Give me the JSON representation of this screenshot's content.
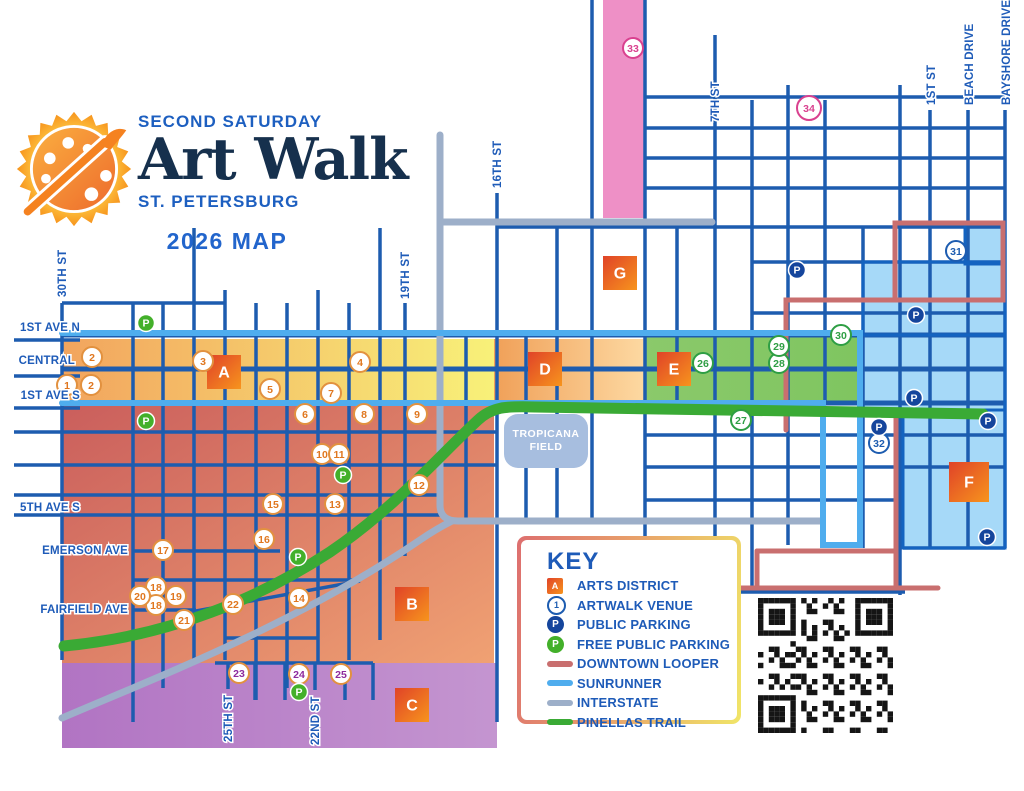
{
  "logo": {
    "line1": "SECOND SATURDAY",
    "line2": "Art Walk",
    "line3": "ST. PETERSBURG",
    "line4": "2026 MAP"
  },
  "key": {
    "title": "KEY",
    "items": [
      {
        "icon": "district-square",
        "label": "ARTS DISTRICT"
      },
      {
        "icon": "venue-circle",
        "label": "ARTWALK VENUE"
      },
      {
        "icon": "public-parking",
        "label": "PUBLIC PARKING"
      },
      {
        "icon": "free-parking",
        "label": "FREE PUBLIC PARKING"
      },
      {
        "icon": "line",
        "label": "DOWNTOWN LOOPER",
        "color": "#c96f6f"
      },
      {
        "icon": "line",
        "label": "SUNRUNNER",
        "color": "#4fadee"
      },
      {
        "icon": "line",
        "label": "INTERSTATE",
        "color": "#9dafc9"
      },
      {
        "icon": "line",
        "label": "PINELLAS TRAIL",
        "color": "#3aaa35"
      }
    ]
  },
  "tropicana": {
    "lines": [
      "TROPICANA",
      "FIELD"
    ],
    "x": 504,
    "y": 414,
    "w": 84,
    "h": 54,
    "fill": "#a7bedf"
  },
  "colors": {
    "street": "#1d5caf",
    "label": "#1e5bb8",
    "looper": "#c96f6f",
    "sunrunner": "#4fadee",
    "interstate": "#9dafc9",
    "trail": "#3aaa35",
    "public_parking": "#15459c",
    "free_parking": "#43b02a",
    "district_grad": [
      "#e04328",
      "#f7941d"
    ]
  },
  "zones": [
    {
      "id": "central-strip",
      "x": 62,
      "y": 339,
      "w": 432,
      "h": 64,
      "c1": "#f2a45e",
      "c2": "#f8f179",
      "dir": "h"
    },
    {
      "id": "d-zone",
      "x": 494,
      "y": 339,
      "w": 151,
      "h": 64,
      "c1": "#f0a058",
      "c2": "#fdd9a2",
      "dir": "h"
    },
    {
      "id": "e-zone",
      "x": 645,
      "y": 337,
      "w": 215,
      "h": 66,
      "c1": "#8bc96b",
      "c2": "#7fc560",
      "dir": "h"
    },
    {
      "id": "salmon-zone",
      "x": 62,
      "y": 403,
      "w": 432,
      "h": 260,
      "c1": "#ca5e5c",
      "c2": "#f0a173",
      "dir": "d"
    },
    {
      "id": "purple-zone",
      "x": 62,
      "y": 663,
      "w": 435,
      "h": 85,
      "c1": "#b174c3",
      "c2": "#c495d0",
      "dir": "h"
    },
    {
      "id": "pink-strip",
      "x": 603,
      "y": 0,
      "w": 41,
      "h": 218,
      "c1": "#ee90c6",
      "c2": "#ee90c6",
      "dir": "h"
    }
  ],
  "blue_zone": {
    "fill": "#a6d9f8",
    "stroke": "#1463c0",
    "rects": [
      [
        965,
        223,
        40,
        41
      ],
      [
        863,
        262,
        142,
        73
      ],
      [
        860,
        335,
        145,
        75
      ],
      [
        903,
        410,
        102,
        138
      ]
    ]
  },
  "streets": {
    "h": [
      [
        303,
        62,
        225
      ],
      [
        335,
        62,
        1005,
        5
      ],
      [
        369,
        62,
        1005,
        5
      ],
      [
        403,
        62,
        1005,
        5
      ],
      [
        432,
        14,
        497
      ],
      [
        465,
        14,
        497
      ],
      [
        495,
        14,
        440
      ],
      [
        515,
        14,
        440
      ],
      [
        551,
        133,
        280
      ],
      [
        580,
        133,
        360
      ],
      [
        610,
        133,
        196
      ],
      [
        638,
        225,
        318
      ],
      [
        663,
        215,
        373
      ],
      [
        97,
        645,
        1005
      ],
      [
        128,
        645,
        1005
      ],
      [
        158,
        645,
        1005
      ],
      [
        188,
        645,
        1005
      ],
      [
        227,
        497,
        1005
      ],
      [
        262,
        752,
        1005
      ],
      [
        313,
        752,
        1005
      ],
      [
        435,
        645,
        1005
      ],
      [
        467,
        645,
        1005
      ],
      [
        500,
        645,
        900
      ],
      [
        548,
        903,
        1005
      ],
      [
        592,
        715,
        905
      ],
      [
        340,
        14,
        80
      ],
      [
        376,
        14,
        80
      ],
      [
        408,
        14,
        80
      ]
    ],
    "v": [
      [
        62,
        303,
        660
      ],
      [
        133,
        303,
        722
      ],
      [
        163,
        303,
        688
      ],
      [
        194,
        228,
        660
      ],
      [
        225,
        290,
        660
      ],
      [
        256,
        303,
        700
      ],
      [
        287,
        303,
        688
      ],
      [
        318,
        290,
        663
      ],
      [
        349,
        303,
        660
      ],
      [
        380,
        228,
        640
      ],
      [
        405,
        303,
        556
      ],
      [
        466,
        335,
        520
      ],
      [
        497,
        193,
        722
      ],
      [
        526,
        335,
        520
      ],
      [
        557,
        227,
        520
      ],
      [
        592,
        0,
        520
      ],
      [
        645,
        0,
        663
      ],
      [
        677,
        227,
        403
      ],
      [
        715,
        35,
        545
      ],
      [
        752,
        100,
        592
      ],
      [
        788,
        85,
        545
      ],
      [
        825,
        100,
        403
      ],
      [
        863,
        227,
        548
      ],
      [
        900,
        85,
        595
      ],
      [
        930,
        110,
        548
      ],
      [
        968,
        110,
        548
      ],
      [
        1005,
        110,
        548
      ],
      [
        228,
        663,
        689
      ],
      [
        255,
        663,
        700
      ],
      [
        285,
        663,
        700
      ],
      [
        315,
        663,
        690
      ],
      [
        345,
        663,
        700
      ],
      [
        373,
        663,
        700
      ]
    ],
    "diag": [
      [
        196,
        611,
        360,
        581
      ]
    ]
  },
  "routes": [
    {
      "name": "interstate",
      "color": "#9dafc9",
      "width": 7,
      "paths": [
        "M 440,135 L 440,505 Q 440,521 458,521 L 820,521",
        "M 62,718 C 160,676 300,622 420,540 Q 436,529 452,521",
        "M 440,222 L 712,222"
      ]
    },
    {
      "name": "downtown-looper",
      "color": "#c96f6f",
      "width": 5,
      "paths": [
        "M 786,430 L 786,300 L 1003,300 L 1003,223 L 895,223 L 895,300",
        "M 896,415 L 896,588",
        "M 757,551 L 896,551",
        "M 757,551 L 757,588",
        "M 650,588 L 938,588"
      ]
    },
    {
      "name": "sunrunner",
      "color": "#4fadee",
      "width": 6,
      "paths": [
        "M 62,333 L 860,333 L 860,545 L 823,545 L 823,403 L 62,403"
      ]
    },
    {
      "name": "pinellas-trail",
      "color": "#3aaa35",
      "width": 11,
      "paths": [
        "M 64,646 C 170,636 260,598 330,552 C 395,508 440,455 478,420 C 492,407 505,406 535,407 L 983,414"
      ]
    }
  ],
  "districts": [
    {
      "letter": "A",
      "x": 224,
      "y": 372
    },
    {
      "letter": "B",
      "x": 412,
      "y": 604
    },
    {
      "letter": "C",
      "x": 412,
      "y": 705
    },
    {
      "letter": "D",
      "x": 545,
      "y": 369
    },
    {
      "letter": "E",
      "x": 674,
      "y": 369
    },
    {
      "letter": "F",
      "x": 969,
      "y": 482,
      "size": 40
    },
    {
      "letter": "G",
      "x": 620,
      "y": 273
    }
  ],
  "venue_styles": {
    "o": {
      "ring": "#e2913f",
      "num": "#e0771f"
    },
    "p": {
      "ring": "#e2913f",
      "num": "#8e2a9e"
    },
    "g": {
      "ring": "#2e9e44",
      "num": "#2e9e44"
    },
    "b": {
      "ring": "#1d5cb0",
      "num": "#1d5cb0"
    },
    "k": {
      "ring": "#d9418f",
      "num": "#d9418f"
    }
  },
  "venues": [
    {
      "n": "1",
      "x": 67,
      "y": 385,
      "c": "o"
    },
    {
      "n": "2",
      "x": 91,
      "y": 385,
      "c": "o"
    },
    {
      "n": "2",
      "x": 92,
      "y": 357,
      "c": "o"
    },
    {
      "n": "3",
      "x": 203,
      "y": 361,
      "c": "o"
    },
    {
      "n": "4",
      "x": 360,
      "y": 362,
      "c": "o"
    },
    {
      "n": "5",
      "x": 270,
      "y": 389,
      "c": "o"
    },
    {
      "n": "6",
      "x": 305,
      "y": 414,
      "c": "o"
    },
    {
      "n": "7",
      "x": 331,
      "y": 393,
      "c": "o"
    },
    {
      "n": "8",
      "x": 364,
      "y": 414,
      "c": "o"
    },
    {
      "n": "9",
      "x": 417,
      "y": 414,
      "c": "o"
    },
    {
      "n": "10",
      "x": 322,
      "y": 454,
      "c": "o"
    },
    {
      "n": "11",
      "x": 339,
      "y": 454,
      "c": "o"
    },
    {
      "n": "12",
      "x": 419,
      "y": 485,
      "c": "o"
    },
    {
      "n": "13",
      "x": 335,
      "y": 504,
      "c": "o"
    },
    {
      "n": "14",
      "x": 299,
      "y": 598,
      "c": "o"
    },
    {
      "n": "15",
      "x": 273,
      "y": 504,
      "c": "o"
    },
    {
      "n": "16",
      "x": 264,
      "y": 539,
      "c": "o"
    },
    {
      "n": "17",
      "x": 163,
      "y": 550,
      "c": "o"
    },
    {
      "n": "18",
      "x": 156,
      "y": 587,
      "c": "o"
    },
    {
      "n": "18",
      "x": 156,
      "y": 605,
      "c": "o"
    },
    {
      "n": "19",
      "x": 176,
      "y": 596,
      "c": "o"
    },
    {
      "n": "20",
      "x": 140,
      "y": 596,
      "c": "o"
    },
    {
      "n": "21",
      "x": 184,
      "y": 620,
      "c": "o"
    },
    {
      "n": "22",
      "x": 233,
      "y": 604,
      "c": "o"
    },
    {
      "n": "23",
      "x": 239,
      "y": 673,
      "c": "p"
    },
    {
      "n": "24",
      "x": 299,
      "y": 674,
      "c": "p"
    },
    {
      "n": "25",
      "x": 341,
      "y": 674,
      "c": "p"
    },
    {
      "n": "26",
      "x": 703,
      "y": 363,
      "c": "g"
    },
    {
      "n": "27",
      "x": 741,
      "y": 420,
      "c": "g"
    },
    {
      "n": "28",
      "x": 779,
      "y": 363,
      "c": "g"
    },
    {
      "n": "29",
      "x": 779,
      "y": 346,
      "c": "g"
    },
    {
      "n": "30",
      "x": 841,
      "y": 335,
      "c": "g"
    },
    {
      "n": "31",
      "x": 956,
      "y": 251,
      "c": "b"
    },
    {
      "n": "32",
      "x": 879,
      "y": 443,
      "c": "b"
    },
    {
      "n": "33",
      "x": 633,
      "y": 48,
      "c": "k"
    },
    {
      "n": "34",
      "x": 809,
      "y": 108,
      "c": "k",
      "r": 12
    }
  ],
  "parking_public": [
    [
      797,
      270
    ],
    [
      916,
      315
    ],
    [
      914,
      398
    ],
    [
      879,
      427
    ],
    [
      988,
      421
    ],
    [
      987,
      537
    ]
  ],
  "parking_free": [
    [
      146,
      323
    ],
    [
      146,
      421
    ],
    [
      343,
      475
    ],
    [
      298,
      557
    ],
    [
      299,
      692
    ]
  ],
  "street_labels": [
    {
      "t": "1ST AVE N",
      "x": 80,
      "y": 331,
      "a": "end"
    },
    {
      "t": "CENTRAL",
      "x": 75,
      "y": 364,
      "a": "end"
    },
    {
      "t": "1ST AVE S",
      "x": 80,
      "y": 399,
      "a": "end"
    },
    {
      "t": "5TH AVE S",
      "x": 80,
      "y": 511,
      "a": "end"
    },
    {
      "t": "EMERSON AVE",
      "x": 128,
      "y": 554,
      "a": "end"
    },
    {
      "t": "FAIRFIELD AVE",
      "x": 128,
      "y": 613,
      "a": "end"
    },
    {
      "t": "30TH ST",
      "x": 66,
      "y": 297,
      "v": 1
    },
    {
      "t": "19TH ST",
      "x": 409,
      "y": 299,
      "v": 1
    },
    {
      "t": "16TH ST",
      "x": 501,
      "y": 188,
      "v": 1
    },
    {
      "t": "7TH ST",
      "x": 719,
      "y": 122,
      "v": 1
    },
    {
      "t": "1ST ST",
      "x": 935,
      "y": 105,
      "v": 1
    },
    {
      "t": "BEACH DRIVE",
      "x": 973,
      "y": 105,
      "v": 1
    },
    {
      "t": "BAYSHORE DRIVE",
      "x": 1010,
      "y": 105,
      "v": 1
    },
    {
      "t": "25TH ST",
      "x": 232,
      "y": 742,
      "v": 1
    },
    {
      "t": "22ND ST",
      "x": 319,
      "y": 745,
      "v": 1
    }
  ]
}
